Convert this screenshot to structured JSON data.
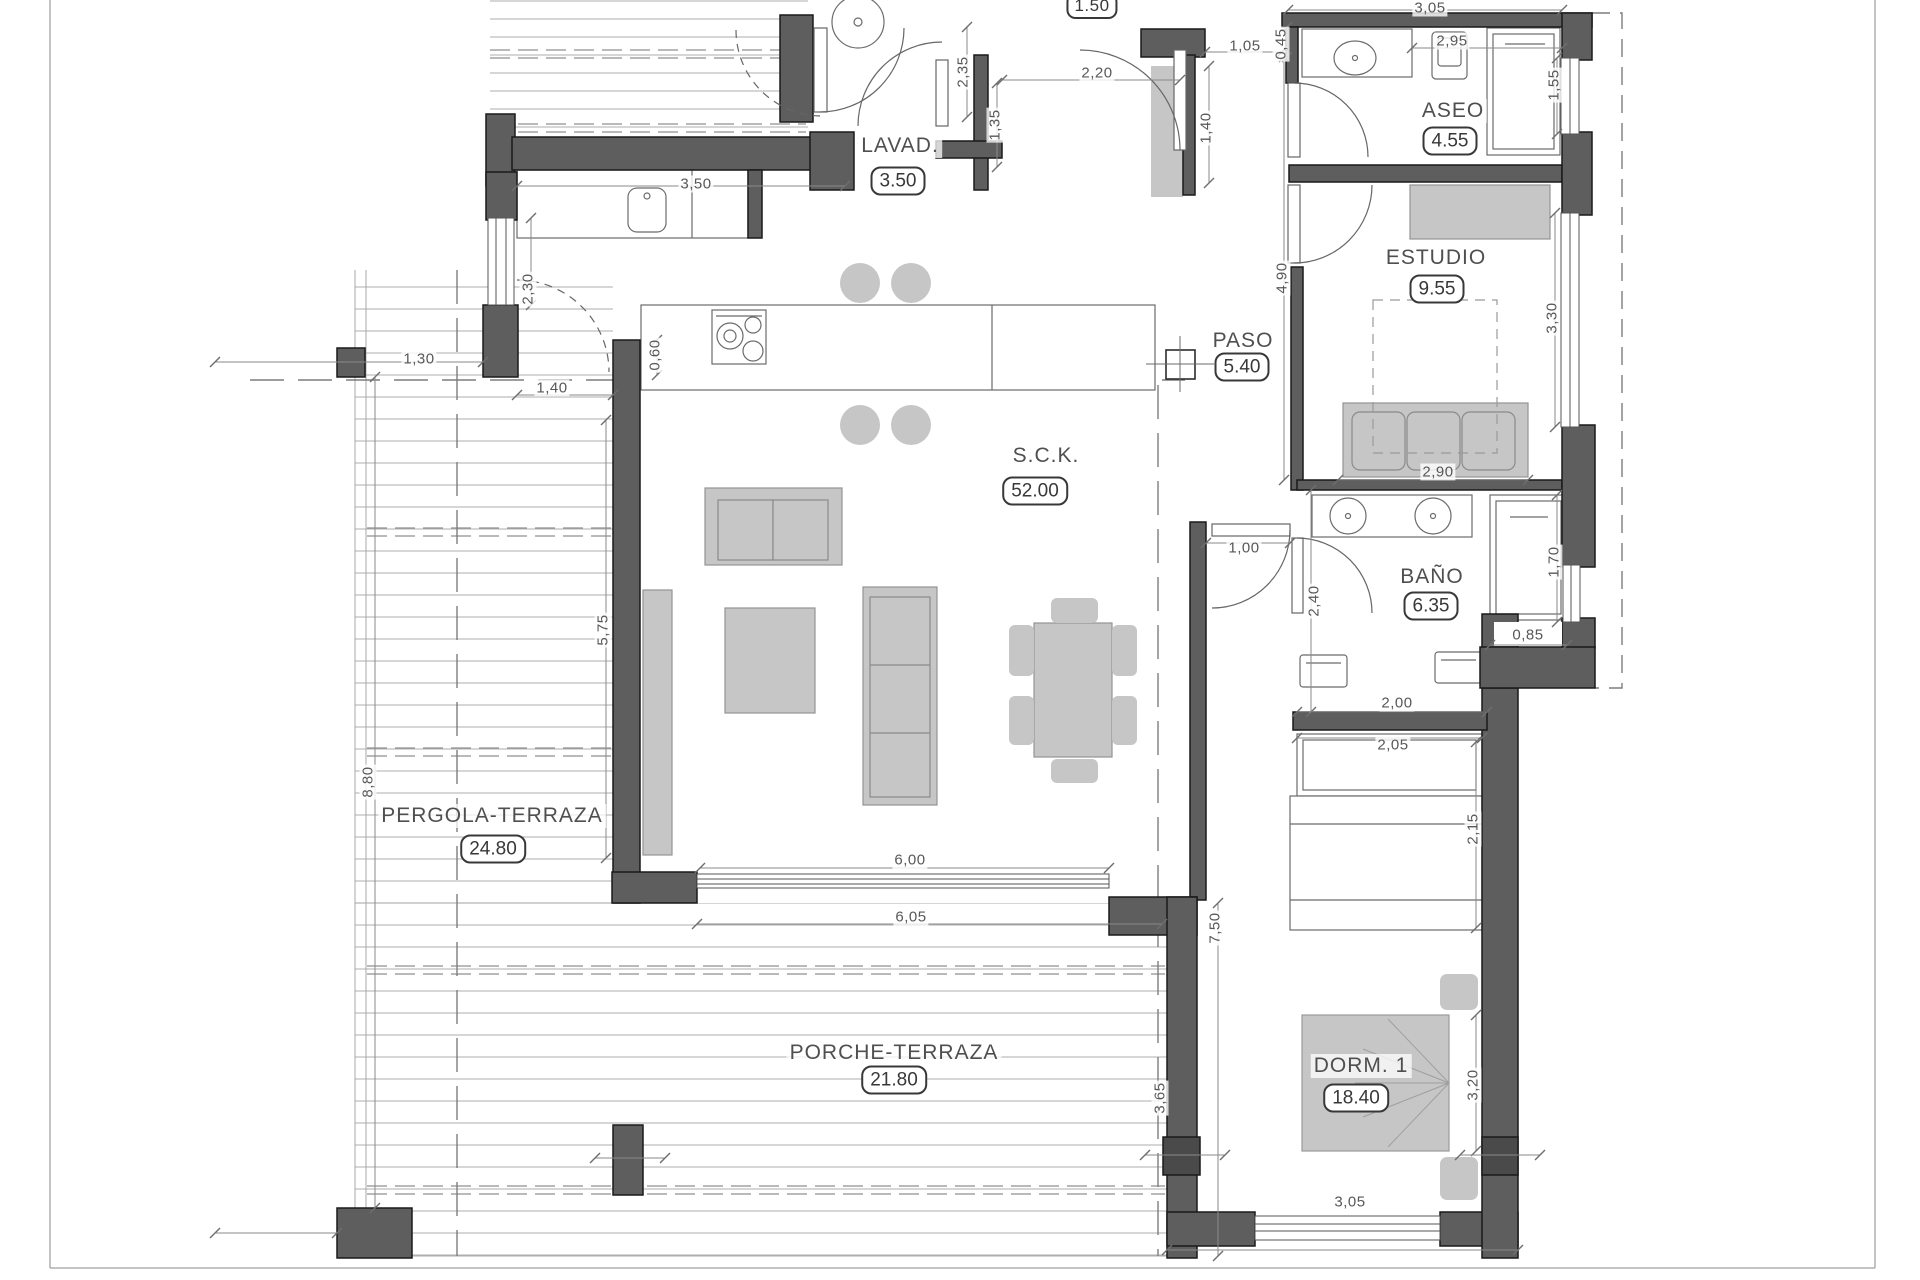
{
  "drawing": {
    "type": "architectural-floor-plan",
    "units": "meters",
    "colors": {
      "wall": "#5e5e5e",
      "wall_stroke": "#1a1a1a",
      "furniture": "#c6c6c6",
      "line": "#9c9c9c",
      "text": "#4f4f4f"
    }
  },
  "rooms": [
    {
      "id": "lavad",
      "label": "LAVAD.",
      "area": "3.50",
      "x": 900,
      "y": 146,
      "bx": 898,
      "by": 181
    },
    {
      "id": "aseo",
      "label": "ASEO",
      "area": "4.55",
      "x": 1453,
      "y": 111,
      "bx": 1450,
      "by": 141
    },
    {
      "id": "estudio",
      "label": "ESTUDIO",
      "area": "9.55",
      "x": 1436,
      "y": 258,
      "bx": 1437,
      "by": 289
    },
    {
      "id": "paso",
      "label": "PASO",
      "area": "5.40",
      "x": 1243,
      "y": 341,
      "bx": 1242,
      "by": 367
    },
    {
      "id": "sck",
      "label": "S.C.K.",
      "area": "52.00",
      "x": 1046,
      "y": 456,
      "bx": 1035,
      "by": 491
    },
    {
      "id": "bano",
      "label": "BAÑO",
      "area": "6.35",
      "x": 1432,
      "y": 577,
      "bx": 1431,
      "by": 606
    },
    {
      "id": "pergola",
      "label": "PERGOLA-TERRAZA",
      "area": "24.80",
      "x": 492,
      "y": 816,
      "bx": 493,
      "by": 849
    },
    {
      "id": "porche",
      "label": "PORCHE-TERRAZA",
      "area": "21.80",
      "x": 894,
      "y": 1053,
      "bx": 894,
      "by": 1080
    },
    {
      "id": "dorm1",
      "label": "DORM. 1",
      "area": "18.40",
      "x": 1361,
      "y": 1066,
      "bx": 1356,
      "by": 1098
    }
  ],
  "dims": [
    {
      "t": "3,50",
      "x": 696,
      "y": 184,
      "r": 0,
      "b": 0
    },
    {
      "t": "2,30",
      "x": 528,
      "y": 289,
      "r": 1,
      "b": 0
    },
    {
      "t": "2,35",
      "x": 963,
      "y": 72,
      "r": 1,
      "b": 0
    },
    {
      "t": "1,35",
      "x": 995,
      "y": 125,
      "r": 1,
      "b": 0
    },
    {
      "t": "1.50",
      "x": 1092,
      "y": 6,
      "r": 0,
      "b": 1
    },
    {
      "t": "2,20",
      "x": 1097,
      "y": 73,
      "r": 0,
      "b": 0
    },
    {
      "t": "1,05",
      "x": 1245,
      "y": 46,
      "r": 0,
      "b": 0
    },
    {
      "t": "0,45",
      "x": 1281,
      "y": 44,
      "r": 1,
      "b": 0
    },
    {
      "t": "3,05",
      "x": 1430,
      "y": 8,
      "r": 0,
      "b": 0
    },
    {
      "t": "2,95",
      "x": 1452,
      "y": 41,
      "r": 0,
      "b": 0
    },
    {
      "t": "1,55",
      "x": 1554,
      "y": 85,
      "r": 1,
      "b": 0
    },
    {
      "t": "1,40",
      "x": 1206,
      "y": 128,
      "r": 1,
      "b": 0
    },
    {
      "t": "4,90",
      "x": 1282,
      "y": 278,
      "r": 1,
      "b": 0
    },
    {
      "t": "3,30",
      "x": 1552,
      "y": 318,
      "r": 1,
      "b": 0
    },
    {
      "t": "0,60",
      "x": 655,
      "y": 355,
      "r": 1,
      "b": 0
    },
    {
      "t": "1,30",
      "x": 419,
      "y": 359,
      "r": 0,
      "b": 0
    },
    {
      "t": "1,40",
      "x": 552,
      "y": 388,
      "r": 0,
      "b": 0
    },
    {
      "t": "2,90",
      "x": 1438,
      "y": 472,
      "r": 0,
      "b": 0
    },
    {
      "t": "1,00",
      "x": 1244,
      "y": 548,
      "r": 0,
      "b": 0
    },
    {
      "t": "2,40",
      "x": 1314,
      "y": 601,
      "r": 1,
      "b": 0
    },
    {
      "t": "1,70",
      "x": 1554,
      "y": 562,
      "r": 1,
      "b": 0
    },
    {
      "t": "0,85",
      "x": 1528,
      "y": 635,
      "r": 0,
      "b": 0
    },
    {
      "t": "2,00",
      "x": 1397,
      "y": 703,
      "r": 0,
      "b": 0
    },
    {
      "t": "2,05",
      "x": 1393,
      "y": 745,
      "r": 0,
      "b": 0
    },
    {
      "t": "2,15",
      "x": 1473,
      "y": 829,
      "r": 1,
      "b": 0
    },
    {
      "t": "5,75",
      "x": 603,
      "y": 630,
      "r": 1,
      "b": 0
    },
    {
      "t": "8,80",
      "x": 368,
      "y": 782,
      "r": 1,
      "b": 0
    },
    {
      "t": "6,00",
      "x": 910,
      "y": 860,
      "r": 0,
      "b": 0
    },
    {
      "t": "6,05",
      "x": 911,
      "y": 917,
      "r": 0,
      "b": 0
    },
    {
      "t": "7,50",
      "x": 1215,
      "y": 928,
      "r": 1,
      "b": 0
    },
    {
      "t": "3,65",
      "x": 1160,
      "y": 1098,
      "r": 1,
      "b": 0
    },
    {
      "t": "3,20",
      "x": 1473,
      "y": 1085,
      "r": 1,
      "b": 0
    },
    {
      "t": "3,05",
      "x": 1350,
      "y": 1202,
      "r": 0,
      "b": 0
    }
  ]
}
